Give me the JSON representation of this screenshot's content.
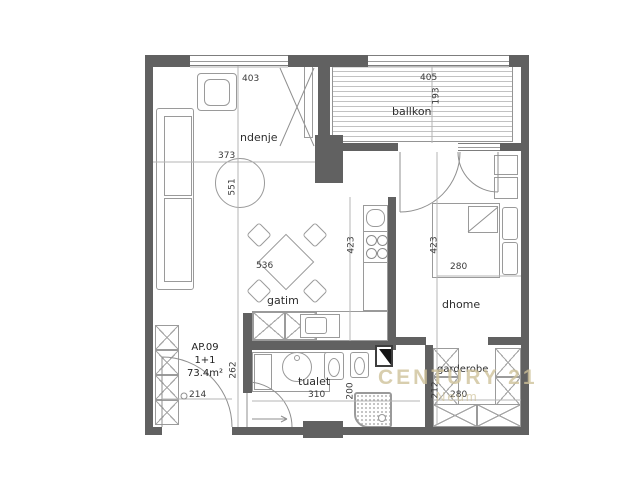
{
  "apartment": {
    "code": "AP.09",
    "layout": "1+1",
    "area": "73.4m²"
  },
  "rooms": {
    "living": "ndenje",
    "balcony": "ballkon",
    "kitchen": "gatim",
    "bedroom": "dhome",
    "bathroom": "tualet",
    "closet": "garderobe"
  },
  "dims": {
    "living_top": "403",
    "balcony_top": "405",
    "balcony_depth": "193",
    "living_width": "373",
    "living_height": "551",
    "kitchen_width": "536",
    "kitchen_height": "423",
    "bedroom_height": "423",
    "bedroom_width": "280",
    "hall_height": "262",
    "entry_door": "214",
    "bath_width": "310",
    "bath_depth": "200",
    "closet_depth": "212",
    "closet_width": "280"
  },
  "watermark": {
    "name": "CENTURY 21",
    "location": "Neum"
  },
  "colors": {
    "wall": "#616161",
    "line": "#9a9a9a",
    "hatch": "#c2c2c2",
    "dim_text": "#3a3a3a",
    "watermark": "#cfc29a"
  }
}
